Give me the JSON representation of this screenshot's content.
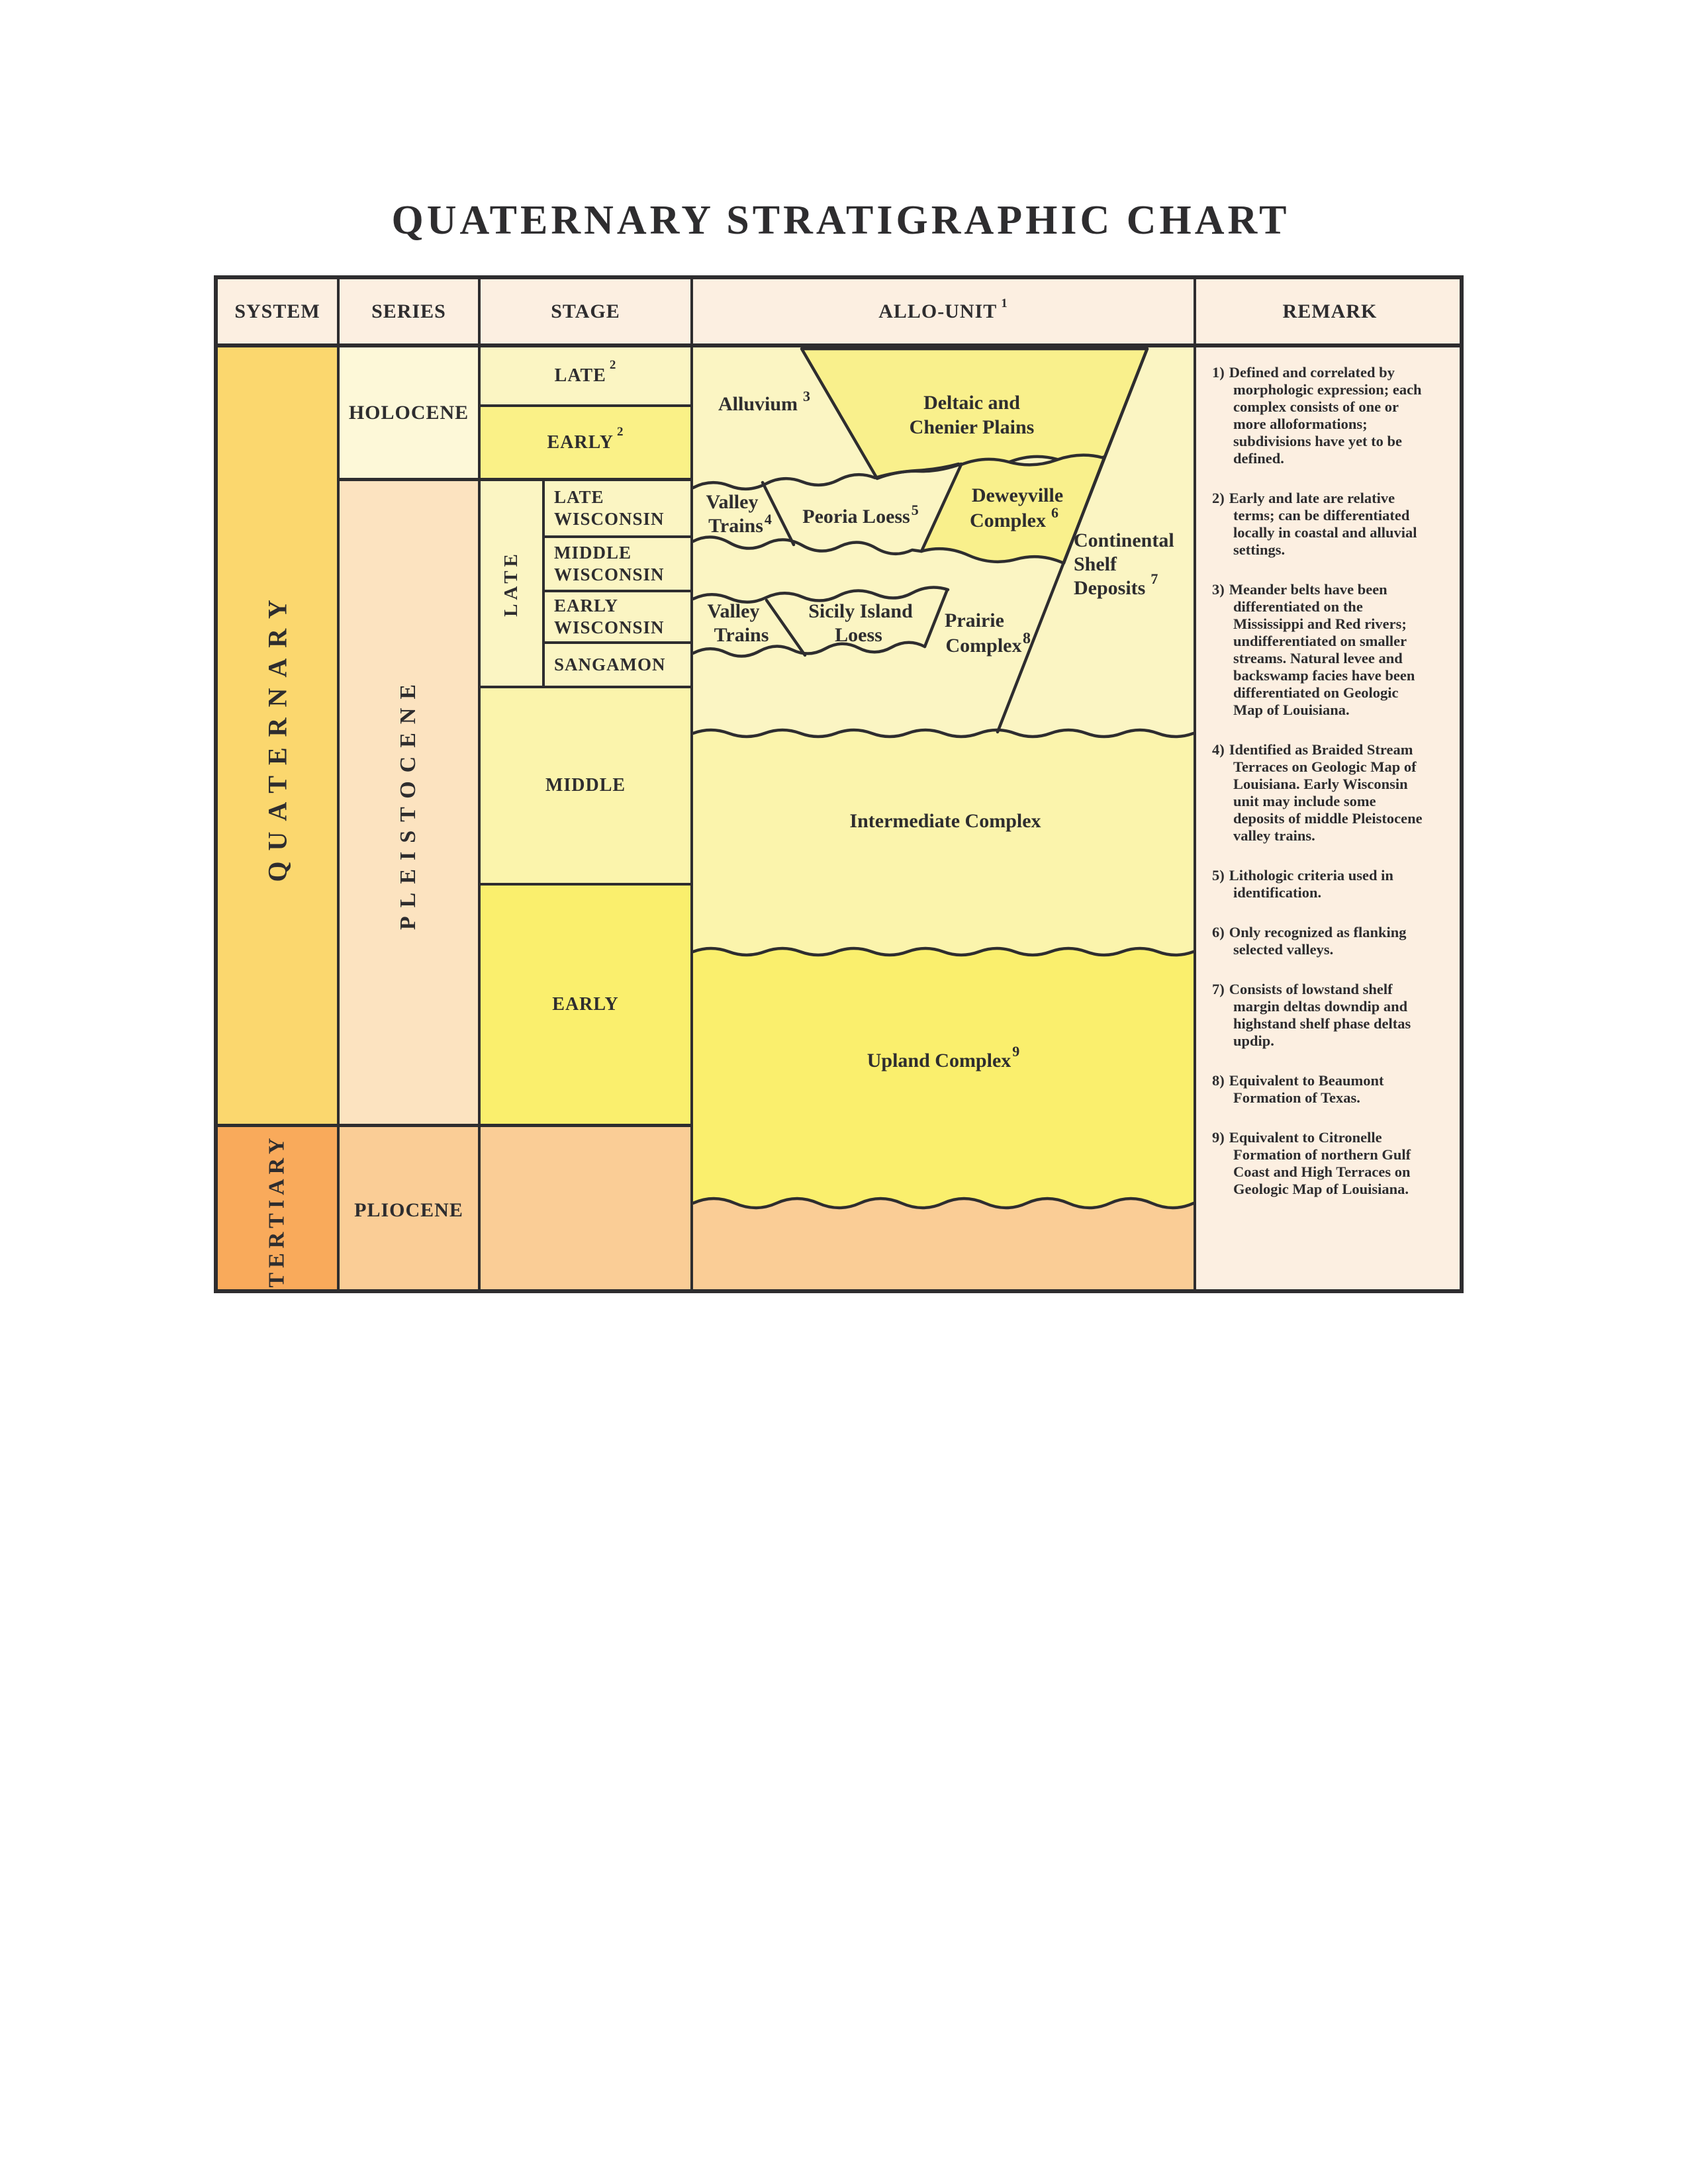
{
  "title": "QUATERNARY STRATIGRAPHIC CHART",
  "header": {
    "system": "SYSTEM",
    "series": "SERIES",
    "stage": "STAGE",
    "allo_unit": "ALLO-UNIT",
    "allo_unit_sup": "1",
    "remark": "REMARK"
  },
  "system": {
    "quaternary": "QUATERNARY",
    "tertiary": "TERTIARY"
  },
  "series": {
    "holocene": "HOLOCENE",
    "pleistocene": "PLEISTOCENE",
    "pliocene": "PLIOCENE"
  },
  "stage": {
    "late": "LATE",
    "late_sup": "2",
    "early": "EARLY",
    "early_sup": "2",
    "late_group": "LATE",
    "late_wisconsin": "LATE WISCONSIN",
    "middle_wisconsin": "MIDDLE WISCONSIN",
    "early_wisconsin": "EARLY WISCONSIN",
    "sangamon": "SANGAMON",
    "middle": "MIDDLE",
    "early_pleistocene": "EARLY"
  },
  "allo": {
    "alluvium": "Alluvium",
    "alluvium_sup": "3",
    "deltaic_line1": "Deltaic and",
    "deltaic_line2": "Chenier Plains",
    "valley1_line1": "Valley",
    "valley1_line2": "Trains",
    "valley1_sup": "4",
    "peoria": "Peoria Loess",
    "peoria_sup": "5",
    "deweyville_line1": "Deweyville",
    "deweyville_line2": "Complex",
    "deweyville_sup": "6",
    "continental_line1": "Continental",
    "continental_line2": "Shelf",
    "continental_line3": "Deposits",
    "continental_sup": "7",
    "valley2_line1": "Valley",
    "valley2_line2": "Trains",
    "sicily_line1": "Sicily Island",
    "sicily_line2": "Loess",
    "prairie_line1": "Prairie",
    "prairie_line2": "Complex",
    "prairie_sup": "8",
    "intermediate": "Intermediate Complex",
    "upland": "Upland Complex",
    "upland_sup": "9"
  },
  "remarks": [
    {
      "num": "1)",
      "text": "Defined and correlated by morphologic expression; each complex consists of one or more alloformations; subdivisions have yet to be defined."
    },
    {
      "num": "2)",
      "text": "Early and late are relative terms; can be differentiated locally in coastal and alluvial settings."
    },
    {
      "num": "3)",
      "text": "Meander belts have been differentiated on the Mississippi and Red rivers; undifferentiated on smaller streams. Natural levee and backswamp facies have been differentiated on Geologic Map of Louisiana."
    },
    {
      "num": "4)",
      "text": "Identified as Braided Stream Terraces on Geologic Map of Louisiana. Early Wisconsin unit may include some deposits of middle Pleistocene valley trains."
    },
    {
      "num": "5)",
      "text": "Lithologic criteria used in identification."
    },
    {
      "num": "6)",
      "text": "Only recognized as flanking selected valleys."
    },
    {
      "num": "7)",
      "text": "Consists of lowstand shelf margin deltas downdip and highstand shelf phase deltas updip."
    },
    {
      "num": "8)",
      "text": "Equivalent to Beaumont Formation of Texas."
    },
    {
      "num": "9)",
      "text": "Equivalent to Citronelle Formation of northern Gulf Coast and High Terraces on Geologic Map of Louisiana."
    }
  ],
  "colors": {
    "ink": "#2e2d2f",
    "header_bg": "#fcefe1",
    "quaternary": "#fbd76e",
    "tertiary": "#f9aa5b",
    "holocene": "#fdf8d8",
    "pleistocene": "#fce3c0",
    "lt_orange": "#facd96",
    "pale": "#fbf5c3",
    "early_holo": "#faf187",
    "mid_yellow": "#fbf4ac",
    "strong_yellow": "#faef6d",
    "bright_yellow": "#f9f08c"
  }
}
